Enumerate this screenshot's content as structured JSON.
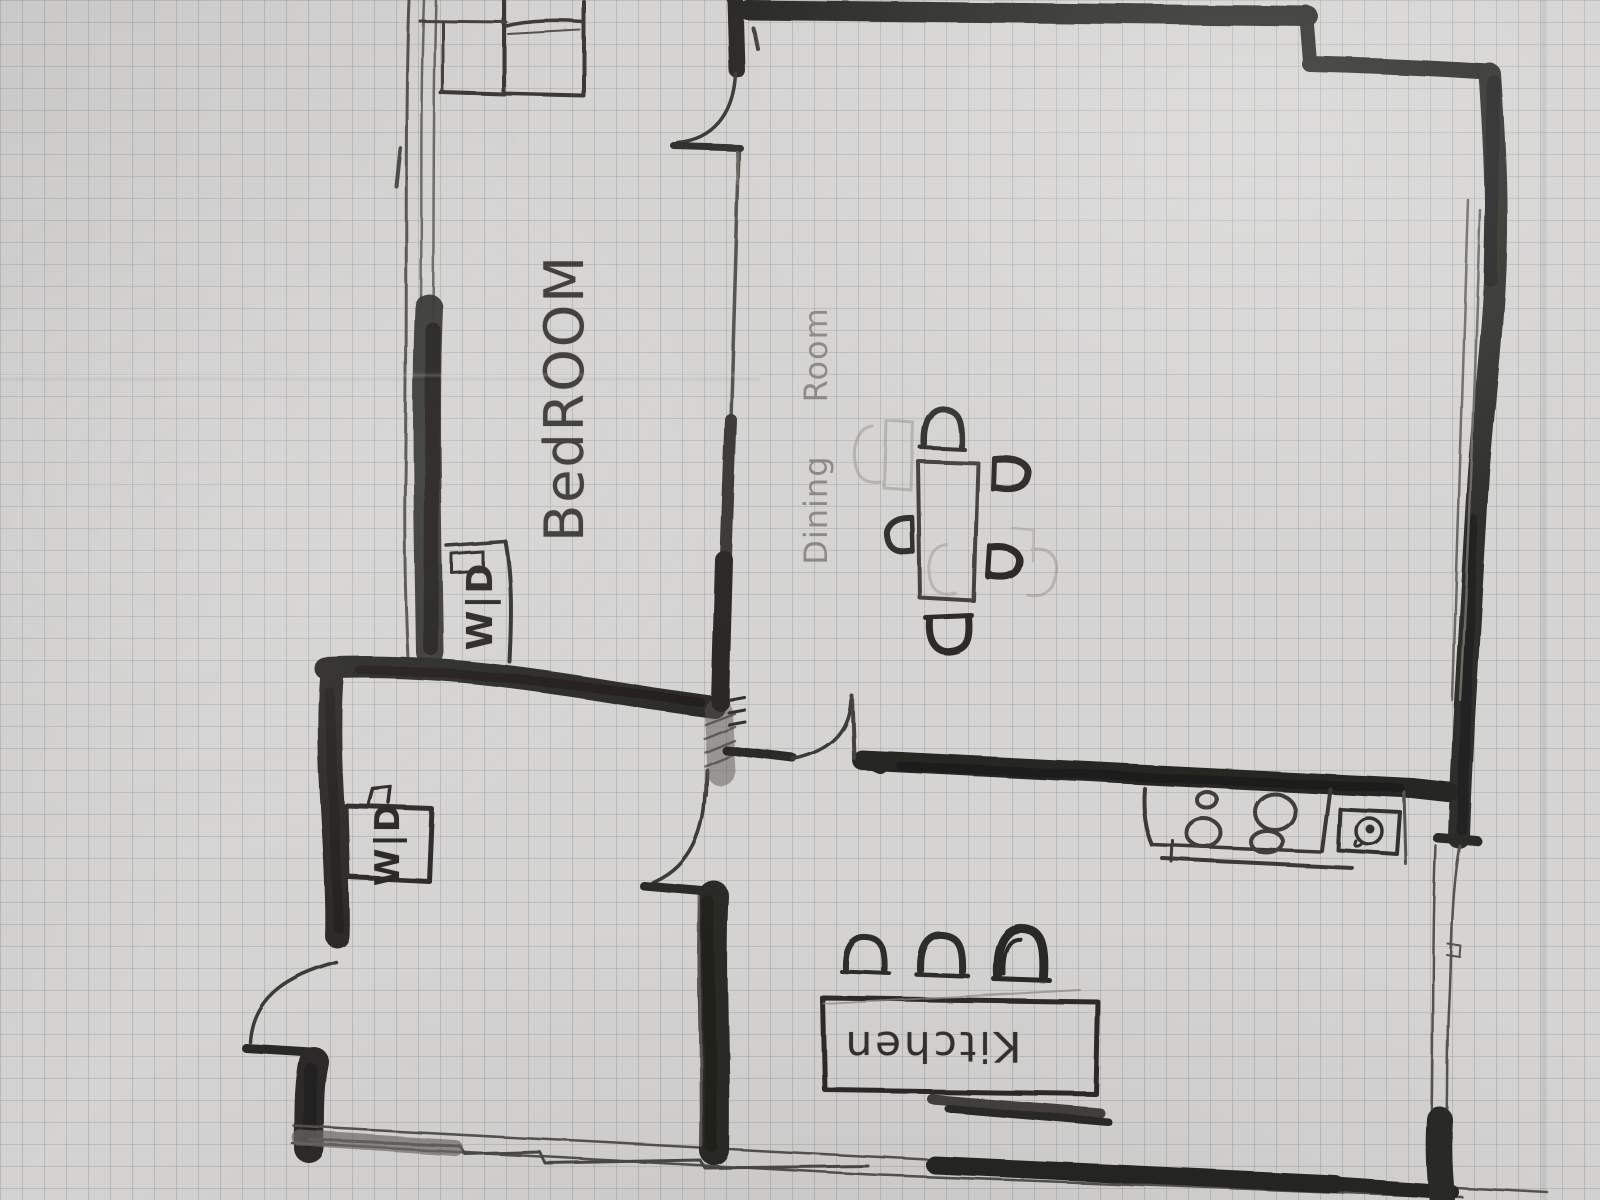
{
  "scene": {
    "description": "Hand-drawn apartment floor plan sketched in pencil and marker on squared graph paper"
  },
  "palette": {
    "paper": "#d5d4d2",
    "grid_line": "#767e89",
    "pencil": "#45433f",
    "pencil_light": "#918e89",
    "marker_dark": "#2b2926"
  },
  "labels": {
    "bedroom": "BedROOM",
    "dining_room": "Dining Room",
    "kitchen": "Kitchen",
    "washer_dryer_closet": "W|D",
    "washer_dryer_hall": "W|D"
  },
  "legend": {
    "icons": [
      "bed-icon",
      "nightstand-icon",
      "closet-icon",
      "washer-dryer-box-icon",
      "dining-table-icon",
      "dining-chair-icon",
      "kitchen-island-icon",
      "bar-stool-icon",
      "stove-icon",
      "burner-icon",
      "sink-icon",
      "door-swing-icon",
      "window-icon",
      "wall"
    ],
    "counts": {
      "dining_chairs": 5,
      "faint_erased_chairs": 4,
      "bar_stools": 3,
      "stove_burners": 4,
      "door_swings": 4
    }
  }
}
